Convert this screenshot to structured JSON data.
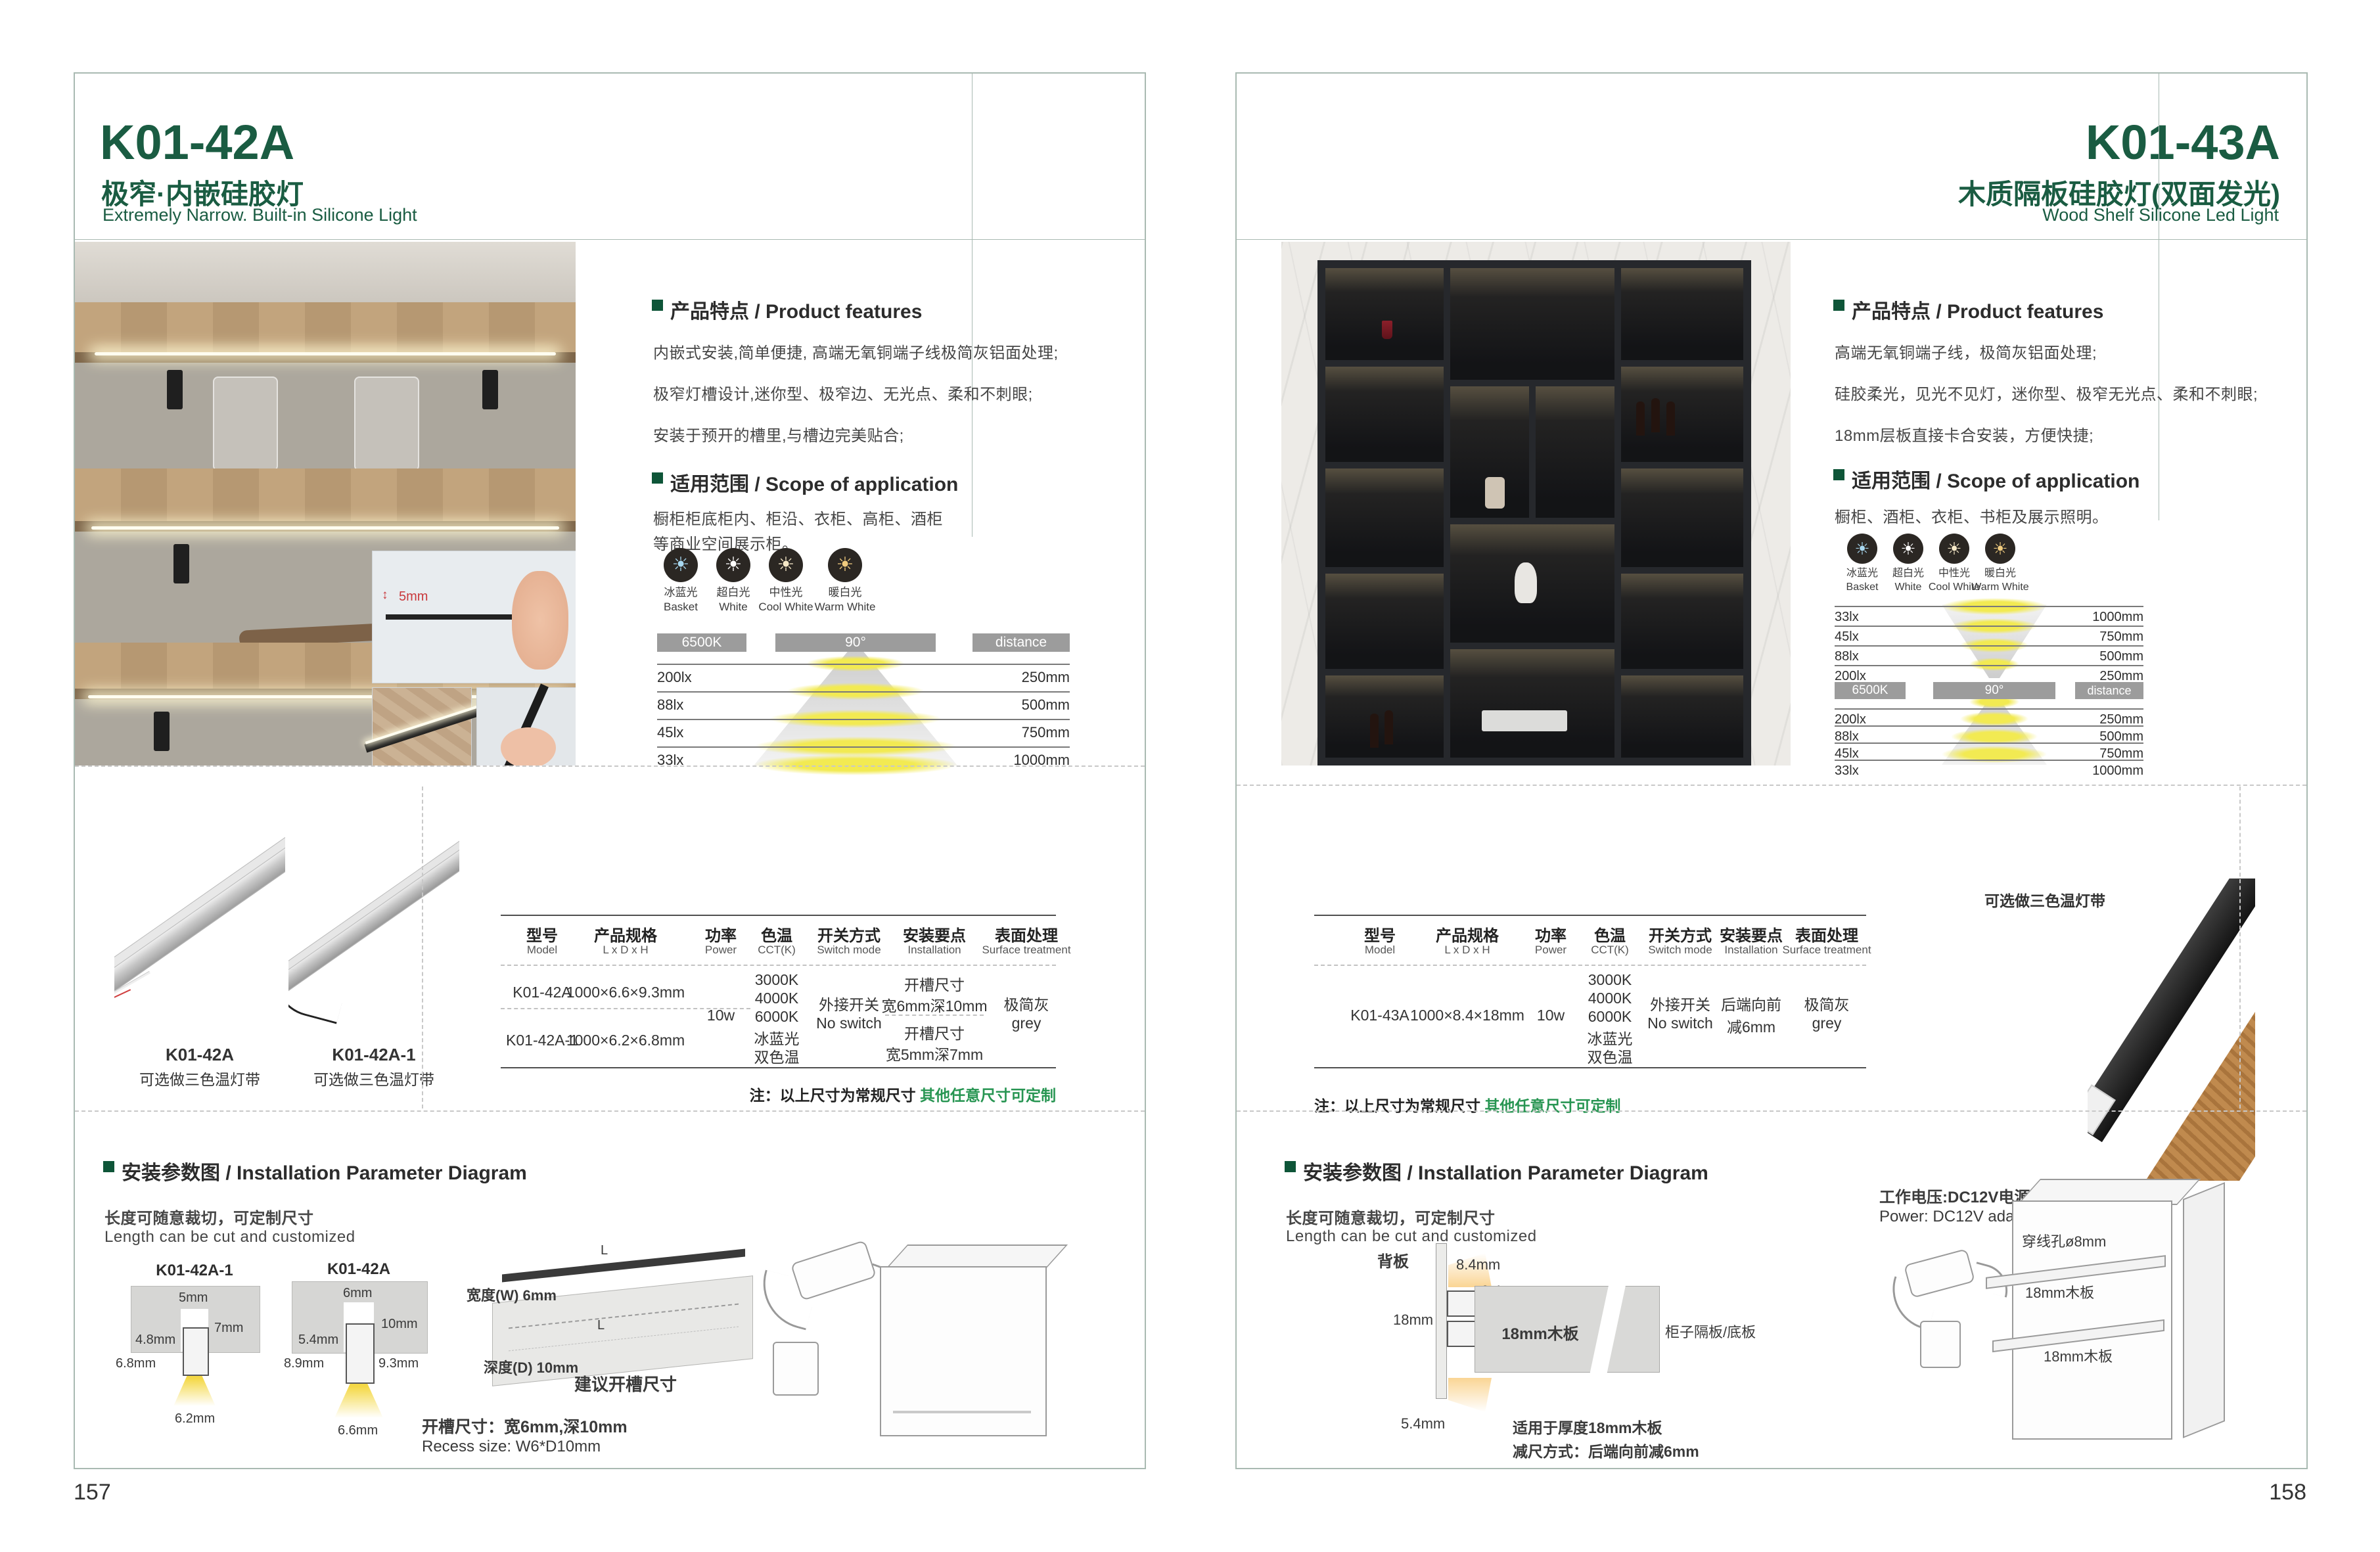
{
  "colors": {
    "brand_green": "#1a5c42",
    "note_green": "#279552",
    "bar_gray": "#9c9c9c",
    "light_yellow": "#f2ea52",
    "ice_blue": "#a8d8f0",
    "pure_white": "#ffffff",
    "neutral_white": "#f6e9c8",
    "warm_white": "#f0cb7e"
  },
  "icons": {
    "sun": "☀"
  },
  "left": {
    "page_number": "157",
    "model": "K01-42A",
    "title_cn": "极窄·内嵌硅胶灯",
    "title_en": "Extremely Narrow. Built-in Silicone Light",
    "features_heading": "产品特点 / Product features",
    "features": [
      "内嵌式安装,简单便捷, 高端无氧铜端子线极简灰铝面处理;",
      "极窄灯槽设计,迷你型、极窄边、无光点、柔和不刺眼;",
      "安装于预开的槽里,与槽边完美贴合;"
    ],
    "scope_heading": "适用范围 / Scope of application",
    "scope": [
      "橱柜柜底柜内、柜沿、衣柜、高柜、酒柜",
      "等商业空间展示柜。"
    ],
    "photo_inset_dim": "5mm",
    "photometric": {
      "modes": [
        {
          "cn": "冰蓝光",
          "en": "Basket",
          "color": "#a8d8f0"
        },
        {
          "cn": "超白光",
          "en": "White",
          "color": "#ffffff"
        },
        {
          "cn": "中性光",
          "en": "Cool White",
          "color": "#f6e9c8"
        },
        {
          "cn": "暖白光",
          "en": "Warm White",
          "color": "#f0cb7e"
        }
      ],
      "cct": "6500K",
      "angle": "90°",
      "distance": "distance",
      "rows": [
        {
          "lux": "200lx",
          "mm": "250mm"
        },
        {
          "lux": "88lx",
          "mm": "500mm"
        },
        {
          "lux": "45lx",
          "mm": "750mm"
        },
        {
          "lux": "33lx",
          "mm": "1000mm"
        }
      ]
    },
    "products": [
      {
        "model": "K01-42A",
        "note": "可选做三色温灯带"
      },
      {
        "model": "K01-42A-1",
        "note": "可选做三色温灯带"
      }
    ],
    "table": {
      "headers": [
        {
          "cn": "型号",
          "en": "Model"
        },
        {
          "cn": "产品规格",
          "en": "L x D x H"
        },
        {
          "cn": "功率",
          "en": "Power"
        },
        {
          "cn": "色温",
          "en": "CCT(K)"
        },
        {
          "cn": "开关方式",
          "en": "Switch mode"
        },
        {
          "cn": "安装要点",
          "en": "Installation"
        },
        {
          "cn": "表面处理",
          "en": "Surface treatment"
        }
      ],
      "rows": [
        {
          "model": "K01-42A",
          "size": "1000×6.6×9.3mm"
        },
        {
          "model": "K01-42A-1",
          "size": "1000×6.2×6.8mm"
        }
      ],
      "power": "10w",
      "cct": [
        "3000K",
        "4000K",
        "6000K",
        "冰蓝光",
        "双色温"
      ],
      "switch_cn": "外接开关",
      "switch_en": "No switch",
      "install": [
        {
          "l1": "开槽尺寸",
          "l2": "宽6mm深10mm"
        },
        {
          "l1": "开槽尺寸",
          "l2": "宽5mm深7mm"
        }
      ],
      "surface_cn": "极简灰",
      "surface_en": "grey",
      "note_black": "注：以上尺寸为常规尺寸 ",
      "note_green": "其他任意尺寸可定制"
    },
    "install": {
      "heading": "安装参数图 / Installation Parameter Diagram",
      "sub_cn": "长度可随意裁切，可定制尺寸",
      "sub_en": "Length can be cut and customized",
      "d1": {
        "model": "K01-42A-1",
        "slot_w": "5mm",
        "slot_d": "7mm",
        "inner_w": "4.8mm",
        "body_h": "6.8mm",
        "bottom_w": "6.2mm"
      },
      "d2": {
        "model": "K01-42A",
        "slot_w": "6mm",
        "slot_d": "10mm",
        "inner_w": "5.4mm",
        "body_h": "8.9mm",
        "body_h2": "9.3mm",
        "bottom_w": "6.6mm"
      },
      "board": {
        "l_top": "L",
        "w": "宽度(W) 6mm",
        "l_in": "L",
        "d": "深度(D) 10mm",
        "caption": "建议开槽尺寸"
      },
      "recess_cn": "开槽尺寸：宽6mm,深10mm",
      "recess_en": "Recess size: W6*D10mm"
    }
  },
  "right": {
    "page_number": "158",
    "model": "K01-43A",
    "title_cn": "木质隔板硅胶灯(双面发光)",
    "title_en": "Wood Shelf Silicone Led Light",
    "features_heading": "产品特点 / Product features",
    "features": [
      "高端无氧铜端子线，极简灰铝面处理;",
      "硅胶柔光，见光不见灯，迷你型、极窄无光点、柔和不刺眼;",
      "18mm层板直接卡合安装，方便快捷;"
    ],
    "scope_heading": "适用范围 / Scope of application",
    "scope": [
      "橱柜、酒柜、衣柜、书柜及展示照明。"
    ],
    "product_note": "可选做三色温灯带",
    "photometric": {
      "modes": [
        {
          "cn": "冰蓝光",
          "en": "Basket",
          "color": "#a8d8f0"
        },
        {
          "cn": "超白光",
          "en": "White",
          "color": "#ffffff"
        },
        {
          "cn": "中性光",
          "en": "Cool White",
          "color": "#f6e9c8"
        },
        {
          "cn": "暖白光",
          "en": "Warm White",
          "color": "#f0cb7e"
        }
      ],
      "cct": "6500K",
      "angle": "90°",
      "distance": "distance",
      "rows_top": [
        {
          "lux": "33lx",
          "mm": "1000mm"
        },
        {
          "lux": "45lx",
          "mm": "750mm"
        },
        {
          "lux": "88lx",
          "mm": "500mm"
        },
        {
          "lux": "200lx",
          "mm": "250mm"
        }
      ],
      "rows_bottom": [
        {
          "lux": "200lx",
          "mm": "250mm"
        },
        {
          "lux": "88lx",
          "mm": "500mm"
        },
        {
          "lux": "45lx",
          "mm": "750mm"
        },
        {
          "lux": "33lx",
          "mm": "1000mm"
        }
      ]
    },
    "table": {
      "headers": [
        {
          "cn": "型号",
          "en": "Model"
        },
        {
          "cn": "产品规格",
          "en": "L x D x H"
        },
        {
          "cn": "功率",
          "en": "Power"
        },
        {
          "cn": "色温",
          "en": "CCT(K)"
        },
        {
          "cn": "开关方式",
          "en": "Switch mode"
        },
        {
          "cn": "安装要点",
          "en": "Installation"
        },
        {
          "cn": "表面处理",
          "en": "Surface treatment"
        }
      ],
      "row": {
        "model": "K01-43A",
        "size": "1000×8.4×18mm",
        "power": "10w"
      },
      "cct": [
        "3000K",
        "4000K",
        "6000K",
        "冰蓝光",
        "双色温"
      ],
      "switch_cn": "外接开关",
      "switch_en": "No switch",
      "install_l1": "后端向前",
      "install_l2": "减6mm",
      "surface_cn": "极简灰",
      "surface_en": "grey",
      "note_black": "注：以上尺寸为常规尺寸 ",
      "note_green": "其他任意尺寸可定制"
    },
    "install": {
      "heading": "安装参数图 / Installation Parameter Diagram",
      "sub_cn": "长度可随意裁切，可定制尺寸",
      "sub_en": "Length can be cut and customized",
      "cs": {
        "back": "背板",
        "d84": "8.4mm",
        "d04": "0.4mm",
        "d18": "18mm",
        "board": "18mm木板",
        "shelf": "柜子隔板/底板",
        "d54": "5.4mm",
        "note1": "适用于厚度18mm木板",
        "note2": "减尺方式：后端向前减6mm"
      },
      "power_cn": "工作电压:DC12V电源适配器",
      "power_en": "Power: DC12V adaptor",
      "cab": {
        "hole": "穿线孔ø8mm",
        "b1": "18mm木板",
        "b2": "18mm木板"
      }
    }
  }
}
